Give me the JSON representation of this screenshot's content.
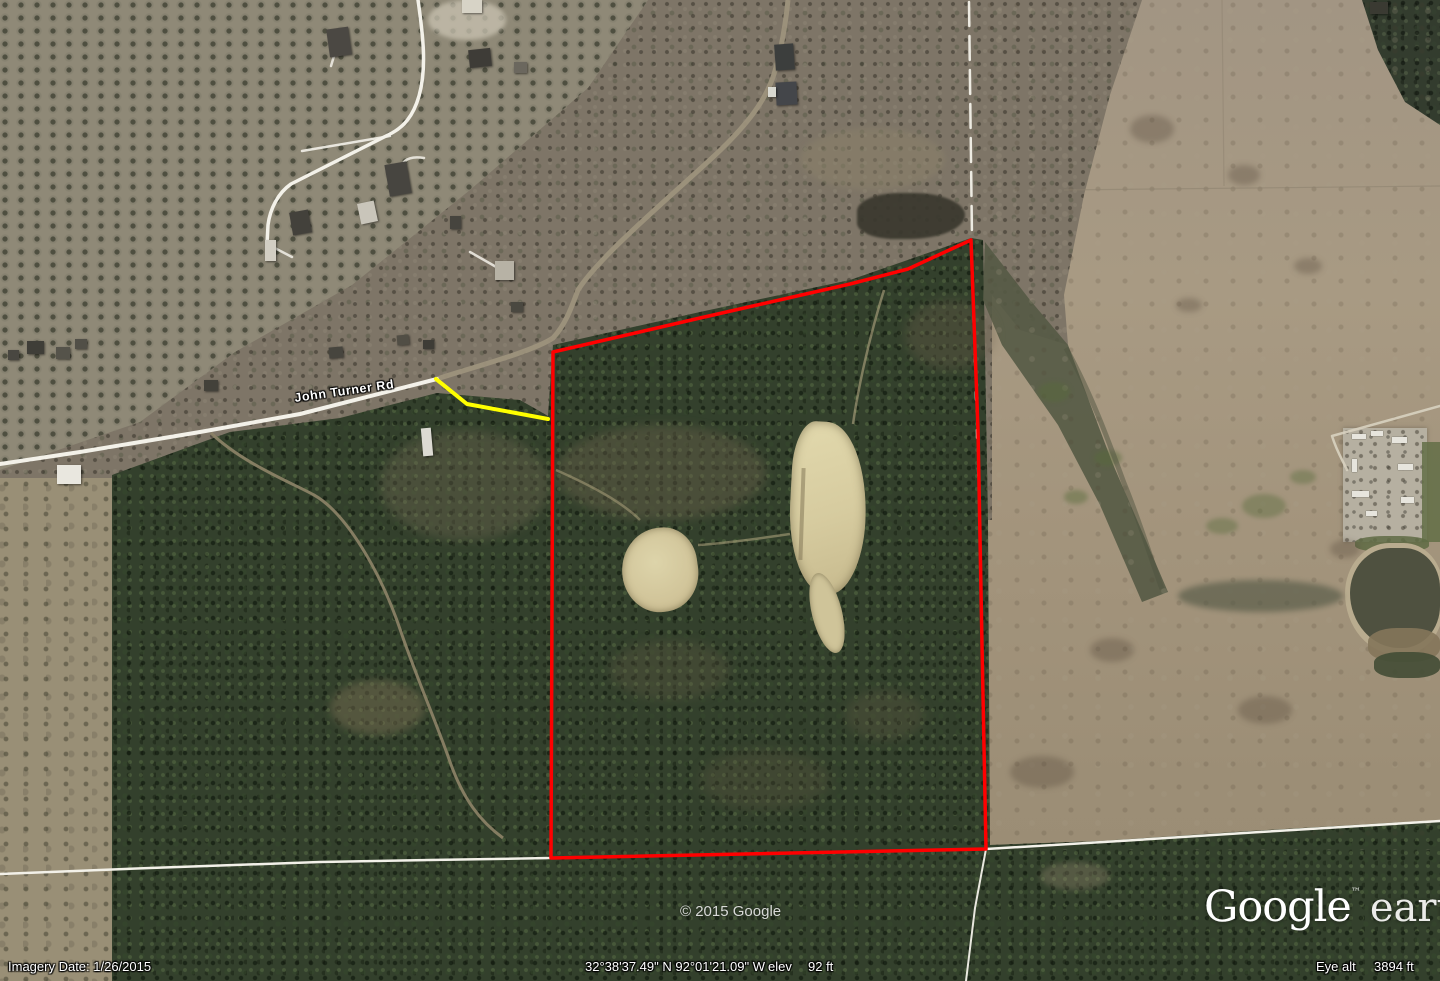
{
  "window": {
    "app": "Google Earth",
    "view": "satellite-imagery"
  },
  "overlay_labels": {
    "road_label": "John Turner Rd",
    "copyright": "© 2015 Google"
  },
  "logo": {
    "brand": "Google",
    "trademark": "™",
    "product": "earth"
  },
  "status_bar": {
    "imagery_date": "Imagery Date: 1/26/2015",
    "coordinates": "32°38'37.49\" N  92°01'21.09\" W",
    "elevation_label": "elev",
    "elevation_value": "92 ft",
    "eye_altitude_label": "Eye alt",
    "eye_altitude_value": "3894 ft"
  },
  "annotations": {
    "property_boundary": {
      "type": "polygon",
      "color": "#ff0000",
      "points": "553,352 700,318 850,284 908,269 971,240 978,430 982,645 986,849 551,858"
    },
    "access_path": {
      "type": "polyline",
      "color": "#ffff00",
      "points": "436,379 467,404 548,419"
    }
  },
  "palette": {
    "pine_forest": "#33402c",
    "leafless_woods": "#7e7567",
    "orchard": "#8f8977",
    "pasture": "#a2947d",
    "sand_pit": "#d9d0a6",
    "pond_water": "#4f5140",
    "road_white": "#f3f1e9"
  }
}
